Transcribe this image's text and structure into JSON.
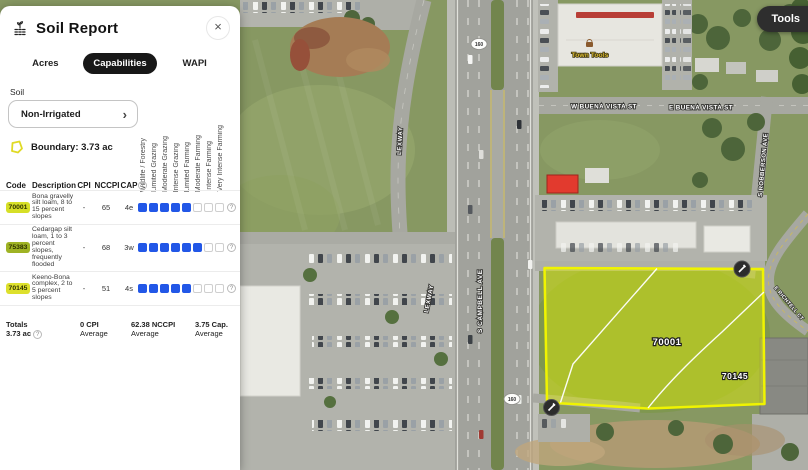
{
  "panel": {
    "title": "Soil Report",
    "close": "×",
    "tabs": [
      {
        "label": "Acres"
      },
      {
        "label": "Capabilities"
      },
      {
        "label": "WAPI"
      }
    ],
    "soil_section_label": "Soil",
    "soil_select_value": "Non-Irrigated",
    "soil_select_chevron": "›",
    "boundary_label": "Boundary: 3.73 ac",
    "help_glyph": "?"
  },
  "soil_table": {
    "headers": {
      "code": "Code",
      "description": "Description",
      "cpi": "CPI",
      "nccpi": "NCCPI",
      "cap": "CAP"
    },
    "rotated_headers": [
      "Wildlife / Forestry",
      "Limited Grazing",
      "Moderate Grazing",
      "Intense Grazing",
      "Limited Farming",
      "Moderate Farming",
      "Intense Farming",
      "Very Intense Farming"
    ],
    "rating_scale": 8,
    "rating_fill_color": "#2257e7",
    "rows": [
      {
        "code": "70001",
        "badge_color": "#d6df27",
        "description": "Bona gravelly silt loam, 8 to 15 percent slopes",
        "cpi": "-",
        "nccpi": "65",
        "cap": "4e",
        "rating_filled": 5
      },
      {
        "code": "75383",
        "badge_color": "#9fb324",
        "description": "Cedargap silt loam, 1 to 3 percent slopes, frequently flooded",
        "cpi": "-",
        "nccpi": "68",
        "cap": "3w",
        "rating_filled": 6
      },
      {
        "code": "70145",
        "badge_color": "#dde02c",
        "description": "Keeno-Bona complex, 2 to 5 percent slopes",
        "cpi": "-",
        "nccpi": "51",
        "cap": "4s",
        "rating_filled": 5
      }
    ],
    "totals": {
      "label": "Totals",
      "area": "3.73 ac",
      "cpi_value": "0 CPI",
      "cpi_sub": "Average",
      "nccpi_value": "62.38 NCCPI",
      "nccpi_sub": "Average",
      "cap_value": "3.75 Cap.",
      "cap_sub": "Average"
    }
  },
  "map": {
    "tools_button_label": "Tools",
    "route_shield_number": "160",
    "poi_label": "Town Tools",
    "streets": {
      "lexway_upper": "LEXWAY",
      "lexway_lower": "LEXWAY",
      "campbell": "S CAMPBELL AVE",
      "buena_vista_w": "W BUENA VISTA ST",
      "buena_vista_e": "E BUENA VISTA ST",
      "robberson": "S ROBBERSON AVE",
      "side_street": "E RICHTELL CT"
    },
    "parcel": {
      "label_main": "70001",
      "label_secondary": "70145"
    }
  }
}
